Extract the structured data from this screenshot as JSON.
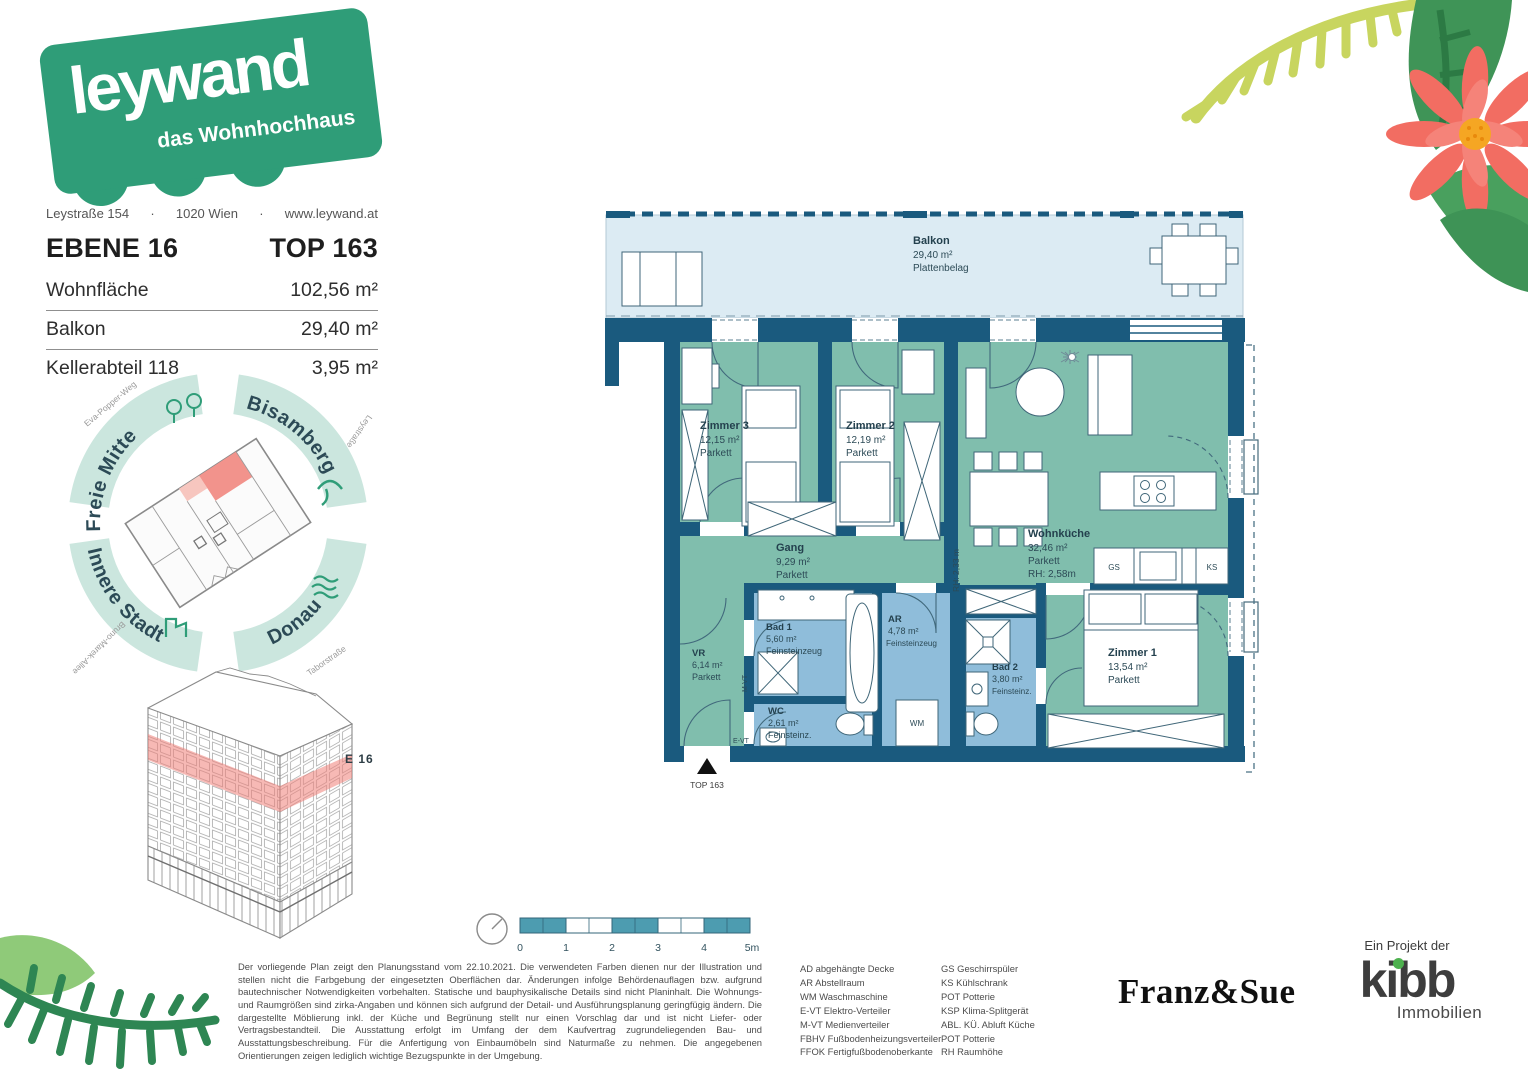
{
  "brand": {
    "name": "leywand",
    "tagline": "das Wohnhochhaus"
  },
  "header": {
    "address_street": "Leystraße 154",
    "address_sep1": "·",
    "address_city": "1020 Wien",
    "address_sep2": "·",
    "address_web": "www.leywand.at",
    "level": "EBENE 16",
    "unit": "TOP 163",
    "rows": [
      {
        "label": "Wohnfläche",
        "value": "102,56 m²"
      },
      {
        "label": "Balkon",
        "value": "29,40 m²"
      },
      {
        "label": "Kellerabteil 118",
        "value": "3,95 m²"
      }
    ]
  },
  "compass": {
    "freie_mitte": "Freie Mitte",
    "bisamberg": "Bisamberg",
    "donau": "Donau",
    "innere_stadt": "Innere Stadt",
    "streets": {
      "nw": "Eva-Popper-Weg",
      "ne": "Leystraße",
      "se": "Taborstraße",
      "sw": "Bruno-Marek-Allee"
    }
  },
  "building": {
    "level_label": "E 16"
  },
  "plan": {
    "rooms": {
      "balkon": {
        "name": "Balkon",
        "area": "29,40 m²",
        "floor": "Plattenbelag"
      },
      "zimmer3": {
        "name": "Zimmer 3",
        "area": "12,15 m²",
        "floor": "Parkett"
      },
      "zimmer2": {
        "name": "Zimmer 2",
        "area": "12,19 m²",
        "floor": "Parkett"
      },
      "wohnkueche": {
        "name": "Wohnküche",
        "area": "32,46 m²",
        "floor": "Parkett",
        "height": "RH: 2,58m"
      },
      "gang": {
        "name": "Gang",
        "area": "9,29 m²",
        "floor": "Parkett"
      },
      "bad1": {
        "name": "Bad 1",
        "area": "5,60 m²",
        "floor": "Feinsteinzeug"
      },
      "ar": {
        "name": "AR",
        "area": "4,78 m²",
        "floor": "Feinsteinzeug"
      },
      "vr": {
        "name": "VR",
        "area": "6,14 m²",
        "floor": "Parkett"
      },
      "wc": {
        "name": "WC",
        "area": "2,61 m²",
        "floor": "Feinsteinz."
      },
      "bad2": {
        "name": "Bad 2",
        "area": "3,80 m²",
        "floor": "Feinsteinz."
      },
      "zimmer1": {
        "name": "Zimmer 1",
        "area": "13,54 m²",
        "floor": "Parkett"
      }
    },
    "tags": {
      "gs": "GS",
      "ks": "KS",
      "wm": "WM",
      "evt": "E-VT",
      "mvt": "M-VT",
      "rh_corridor": "RH: 2,33 m",
      "entrance": "TOP 163"
    }
  },
  "scalebar": {
    "t0": "0",
    "t1": "1",
    "t2": "2",
    "t3": "3",
    "t4": "4",
    "t5": "5m"
  },
  "disclaimer": "Der vorliegende Plan zeigt den Planungsstand vom 22.10.2021. Die verwendeten Farben dienen nur der Illustration und stellen nicht die Farbgebung der eingesetzten Oberflächen dar. Änderungen infolge Behördenauflagen bzw. aufgrund bautechnischer Notwendigkeiten vorbehalten. Statische und bauphysikalische Details sind nicht Planinhalt. Die Wohnungs- und Raumgrößen sind zirka-Angaben und können sich aufgrund der Detail- und Ausführungsplanung geringfügig ändern. Die dargestellte Möblierung inkl. der Küche und Begrünung stellt nur einen Vorschlag dar und ist nicht Liefer- oder Vertragsbestandteil. Die Ausstattung erfolgt im Umfang der dem Kaufvertrag zugrundeliegenden Bau- und Ausstattungsbeschreibung. Für die Anfertigung von Einbaumöbeln sind Naturmaße zu nehmen. Die angegebenen Orientierungen zeigen lediglich wichtige Bezugspunkte in der Umgebung.",
  "legend": {
    "col1": [
      "AD abgehängte Decke",
      "AR Abstellraum",
      "WM Waschmaschine",
      "E-VT Elektro-Verteiler",
      "M-VT Medienverteiler",
      "FBHV Fußbodenheizungsverteiler",
      "FFOK Fertigfußbodenoberkante"
    ],
    "col2": [
      "GS Geschirrspüler",
      "KS Kühlschrank",
      "POT Potterie",
      "KSP Klima-Splitgerät",
      "ABL. KÜ.  Abluft Küche",
      "POT Potterie",
      "RH Raumhöhe"
    ]
  },
  "partners": {
    "architect": "Franz&Sue",
    "project_prefix": "Ein Projekt der",
    "developer": "kibb",
    "developer_sub": "Immobilien"
  },
  "colors": {
    "brand_green": "#2f9d78",
    "wall_blue": "#1a5a7e",
    "room_teal": "#80bead",
    "wet_blue": "#8fbdda",
    "balcony_blue": "#dcebf3",
    "highlight_red": "#f2938c",
    "scale_teal": "#4d9cb0",
    "ring_mint": "#cbe6de"
  }
}
